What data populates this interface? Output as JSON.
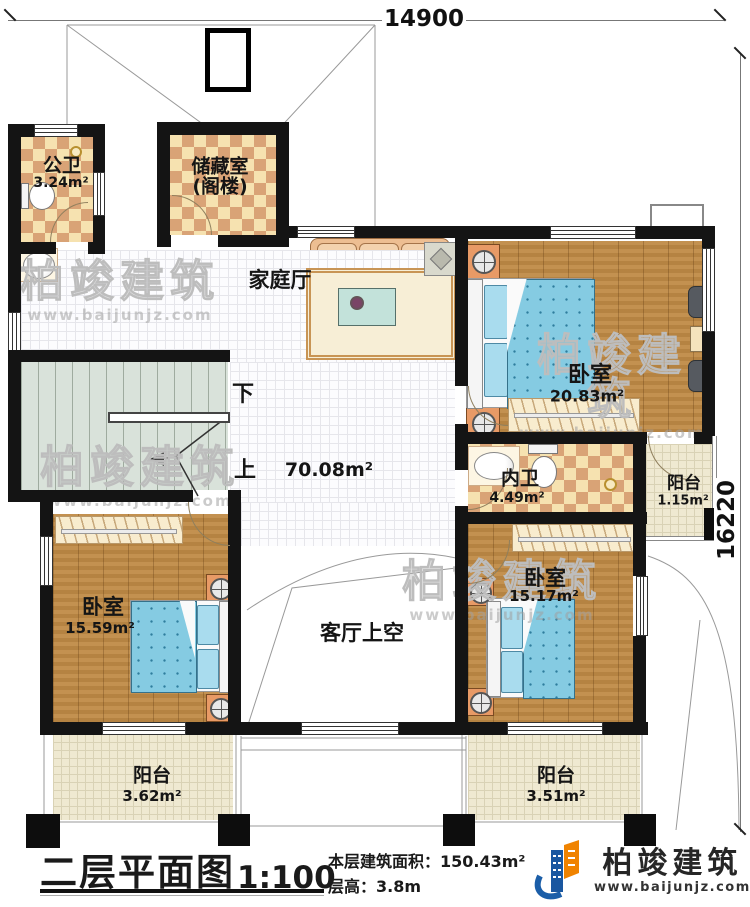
{
  "title_block": {
    "title": "二层平面图",
    "scale": "1:100",
    "area_label": "本层建筑面积：",
    "area_value": "150.43m²",
    "height_label": "层高：",
    "height_value": "3.8m"
  },
  "dimensions": {
    "width_mm": "14900",
    "height_mm": "16220"
  },
  "rooms": {
    "public_bath": {
      "name": "公卫",
      "area": "3.24m²"
    },
    "storage": {
      "name": "储藏室",
      "sub": "(阁楼)"
    },
    "family_hall": {
      "name": "家庭厅",
      "area": "70.08m²"
    },
    "bedroom_top_right": {
      "name": "卧室",
      "area": "20.83m²"
    },
    "inner_bath": {
      "name": "内卫",
      "area": "4.49m²"
    },
    "balcony_right": {
      "name": "阳台",
      "area": "1.15m²"
    },
    "bedroom_bottom_left": {
      "name": "卧室",
      "area": "15.59m²"
    },
    "living_room_void": {
      "name": "客厅上空"
    },
    "bedroom_bottom_right": {
      "name": "卧室",
      "area": "15.17m²"
    },
    "balcony_bottom_left": {
      "name": "阳台",
      "area": "3.62m²"
    },
    "balcony_bottom_right": {
      "name": "阳台",
      "area": "3.51m²"
    }
  },
  "stairs": {
    "down_label": "下",
    "up_label": "上"
  },
  "brand": {
    "name": "柏竣建筑",
    "website": "www.baijunjz.com"
  },
  "watermark": {
    "name": "柏竣建筑",
    "website": "www.baijunjz.com"
  },
  "colors": {
    "wall": "#141414",
    "checker_dark": "#d9a376",
    "checker_light": "#f6e2b0",
    "wood": "#bf8a45",
    "bed_blue": "#85cbe2",
    "stair": "#d9e2da",
    "balcony": "#efe9d1",
    "logo_blue": "#1b5ea8",
    "logo_orange": "#f08300"
  }
}
